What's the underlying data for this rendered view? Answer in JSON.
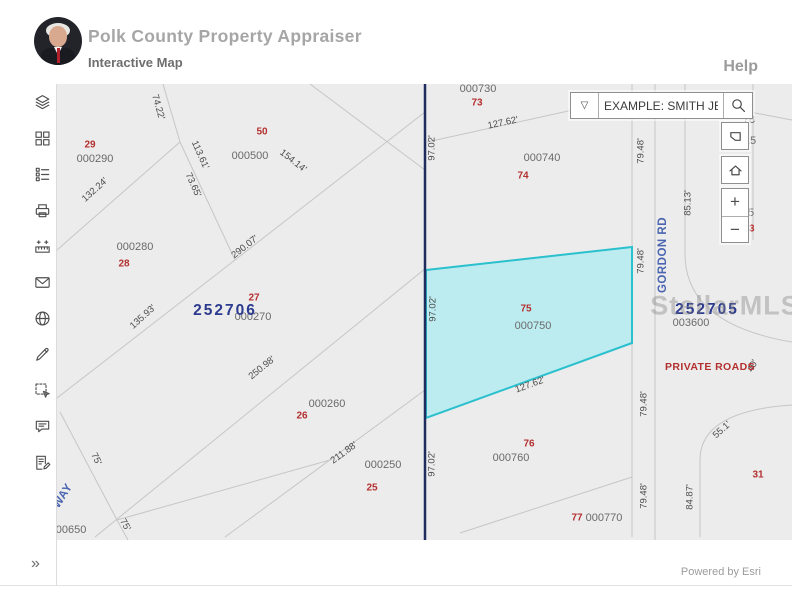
{
  "header": {
    "title": "Polk County Property Appraiser",
    "subtitle": "Interactive Map",
    "help": "Help"
  },
  "search": {
    "placeholder": "EXAMPLE: SMITH JER...",
    "dropdown_glyph": "▽"
  },
  "map_controls": {
    "zoom_in_label": "+",
    "zoom_out_label": "−"
  },
  "sidebar": {
    "expand_label": "»",
    "items": [
      {
        "name": "layers",
        "icon": "layers-icon"
      },
      {
        "name": "basemaps",
        "icon": "basemap-grid-icon"
      },
      {
        "name": "legend",
        "icon": "legend-list-icon"
      },
      {
        "name": "print",
        "icon": "print-icon"
      },
      {
        "name": "measure",
        "icon": "measure-icon"
      },
      {
        "name": "share-email",
        "icon": "envelope-icon"
      },
      {
        "name": "web-links",
        "icon": "globe-icon"
      },
      {
        "name": "draw",
        "icon": "pencil-icon"
      },
      {
        "name": "select",
        "icon": "select-area-icon"
      },
      {
        "name": "comments",
        "icon": "comment-icon"
      },
      {
        "name": "reports",
        "icon": "report-edit-icon"
      }
    ]
  },
  "map": {
    "background": "#ececec",
    "watermark": {
      "text": "StellarMLS",
      "x": 668,
      "y": 222
    },
    "section_labels": [
      {
        "text": "252706",
        "x": 168,
        "y": 227
      },
      {
        "text": "252705",
        "x": 650,
        "y": 226
      }
    ],
    "parcel_ids": [
      {
        "text": "000290",
        "x": 38,
        "y": 75
      },
      {
        "text": "000500",
        "x": 193,
        "y": 72
      },
      {
        "text": "000280",
        "x": 78,
        "y": 163
      },
      {
        "text": "000270",
        "x": 196,
        "y": 233
      },
      {
        "text": "000260",
        "x": 270,
        "y": 320
      },
      {
        "text": "000250",
        "x": 326,
        "y": 381
      },
      {
        "text": "000730",
        "x": 421,
        "y": 5
      },
      {
        "text": "000740",
        "x": 485,
        "y": 74
      },
      {
        "text": "000750",
        "x": 476,
        "y": 242
      },
      {
        "text": "000760",
        "x": 454,
        "y": 374
      },
      {
        "text": "000770",
        "x": 547,
        "y": 434
      },
      {
        "text": "003600",
        "x": 634,
        "y": 239
      },
      {
        "text": "000650",
        "x": 11,
        "y": 446
      },
      {
        "text": "78",
        "x": 692,
        "y": 36
      },
      {
        "text": "15",
        "x": 693,
        "y": 57
      },
      {
        "text": "335",
        "x": 688,
        "y": 129
      }
    ],
    "parcel_numbers": [
      {
        "text": "29",
        "x": 33,
        "y": 61
      },
      {
        "text": "50",
        "x": 205,
        "y": 48
      },
      {
        "text": "28",
        "x": 67,
        "y": 180
      },
      {
        "text": "27",
        "x": 197,
        "y": 214
      },
      {
        "text": "26",
        "x": 245,
        "y": 332
      },
      {
        "text": "25",
        "x": 315,
        "y": 404
      },
      {
        "text": "73",
        "x": 420,
        "y": 19
      },
      {
        "text": "74",
        "x": 466,
        "y": 92
      },
      {
        "text": "75",
        "x": 469,
        "y": 225
      },
      {
        "text": "76",
        "x": 472,
        "y": 360
      },
      {
        "text": "77",
        "x": 520,
        "y": 434
      },
      {
        "text": "33",
        "x": 692,
        "y": 145
      },
      {
        "text": "31",
        "x": 701,
        "y": 391
      }
    ],
    "dimensions": [
      {
        "text": "74.22'",
        "x": 101,
        "y": 23,
        "rot": 74
      },
      {
        "text": "113.61'",
        "x": 143,
        "y": 71,
        "rot": 66
      },
      {
        "text": "73.65'",
        "x": 136,
        "y": 101,
        "rot": 66
      },
      {
        "text": "132.24'",
        "x": 38,
        "y": 106,
        "rot": -42
      },
      {
        "text": "290.07'",
        "x": 188,
        "y": 163,
        "rot": -38
      },
      {
        "text": "135.93'",
        "x": 86,
        "y": 233,
        "rot": -42
      },
      {
        "text": "154.14'",
        "x": 236,
        "y": 77,
        "rot": 38
      },
      {
        "text": "250.98'",
        "x": 205,
        "y": 284,
        "rot": -39
      },
      {
        "text": "211.88'",
        "x": 287,
        "y": 369,
        "rot": -36
      },
      {
        "text": "75'",
        "x": 39,
        "y": 375,
        "rot": 64
      },
      {
        "text": "75'",
        "x": 68,
        "y": 441,
        "rot": 60
      },
      {
        "text": "97.02'",
        "x": 375,
        "y": 64,
        "rot": -90
      },
      {
        "text": "97.02'",
        "x": 376,
        "y": 225,
        "rot": -90
      },
      {
        "text": "97.02'",
        "x": 375,
        "y": 380,
        "rot": -90
      },
      {
        "text": "127.62'",
        "x": 446,
        "y": 39,
        "rot": -12
      },
      {
        "text": "127.62'",
        "x": 473,
        "y": 301,
        "rot": -20
      },
      {
        "text": "79.48'",
        "x": 584,
        "y": 67,
        "rot": -90
      },
      {
        "text": "79.48'",
        "x": 584,
        "y": 177,
        "rot": -90
      },
      {
        "text": "79.48'",
        "x": 587,
        "y": 320,
        "rot": -90
      },
      {
        "text": "79.48'",
        "x": 587,
        "y": 412,
        "rot": -90
      },
      {
        "text": "85.13'",
        "x": 631,
        "y": 119,
        "rot": -90
      },
      {
        "text": "84.87'",
        "x": 633,
        "y": 413,
        "rot": -90
      },
      {
        "text": "55.1'",
        "x": 665,
        "y": 346,
        "rot": -42
      },
      {
        "text": "40'",
        "x": 696,
        "y": 282,
        "rot": -62
      }
    ],
    "roads": [
      {
        "text": "GORDON RD",
        "x": 606,
        "y": 171,
        "rot": -90
      },
      {
        "text": "WAY",
        "x": 6,
        "y": 412,
        "rot": -58
      }
    ],
    "notes": [
      {
        "text": "PRIVATE ROADS",
        "x": 653,
        "y": 283
      }
    ],
    "geometry": {
      "line_color": "#c6c6c6",
      "lines": [
        {
          "x1": 106,
          "y1": 0,
          "x2": 123,
          "y2": 58
        },
        {
          "x1": 123,
          "y1": 58,
          "x2": 0,
          "y2": 166
        },
        {
          "x1": 123,
          "y1": 58,
          "x2": 178,
          "y2": 176
        },
        {
          "x1": 0,
          "y1": 314,
          "x2": 178,
          "y2": 176
        },
        {
          "x1": 178,
          "y1": 176,
          "x2": 368,
          "y2": 28
        },
        {
          "x1": 253,
          "y1": 0,
          "x2": 368,
          "y2": 86
        },
        {
          "x1": 38,
          "y1": 453,
          "x2": 369,
          "y2": 184
        },
        {
          "x1": 168,
          "y1": 453,
          "x2": 368,
          "y2": 306
        },
        {
          "x1": 3,
          "y1": 328,
          "x2": 60,
          "y2": 436
        },
        {
          "x1": 60,
          "y1": 436,
          "x2": 273,
          "y2": 376
        },
        {
          "x1": 60,
          "y1": 436,
          "x2": 71,
          "y2": 456
        },
        {
          "x1": 370,
          "y1": 58,
          "x2": 593,
          "y2": 9
        },
        {
          "x1": 593,
          "y1": 9,
          "x2": 735,
          "y2": 36
        },
        {
          "x1": 403,
          "y1": 449,
          "x2": 575,
          "y2": 393
        },
        {
          "x1": 575,
          "y1": 0,
          "x2": 575,
          "y2": 453
        },
        {
          "x1": 598,
          "y1": 0,
          "x2": 598,
          "y2": 456
        },
        {
          "x1": 628,
          "y1": 0,
          "x2": 628,
          "y2": 170
        },
        {
          "x1": 696,
          "y1": 0,
          "x2": 696,
          "y2": 156
        }
      ],
      "paths": [
        {
          "d": "M628,170 Q628,240 735,258"
        },
        {
          "d": "M643,453 L643,376 Q643,327 735,321"
        }
      ],
      "section_line": {
        "x1": 368,
        "y1": 0,
        "x2": 368,
        "y2": 456,
        "color": "#1e2c5e"
      },
      "highlight": {
        "points": "369,186 575,163 575,259 369,334",
        "fill": "#b5ecf1",
        "stroke": "#2bc0ce"
      }
    }
  },
  "footer": {
    "attribution": "Powered by Esri"
  }
}
